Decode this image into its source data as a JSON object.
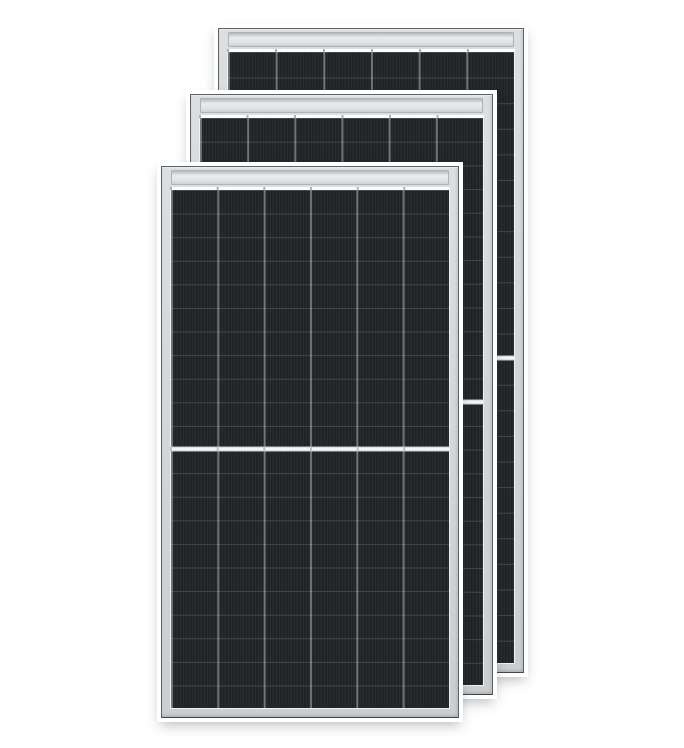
{
  "scene": {
    "description": "Product image: three stacked rectangular solar panels with black half-cut cells and silver aluminum frames on a plain white background",
    "background_color": "#ffffff"
  },
  "panel_spec": {
    "panel_count": 3,
    "cell_columns": 6,
    "cell_rows_per_half": 12,
    "halves_per_panel": 2,
    "center_divider_color": "#f3f4f5",
    "frame_color": "#d3d6d8",
    "frame_edge_color": "#5c6163",
    "cell_color": "#202326",
    "column_line_color": "rgba(255,255,255,0.35)",
    "halo_color": "#ffffff"
  },
  "panels": [
    {
      "id": "back",
      "x": 218,
      "y": 28,
      "width": 306,
      "height": 645,
      "row_height_px": 25.6,
      "z": 1
    },
    {
      "id": "middle",
      "x": 190,
      "y": 94,
      "width": 303,
      "height": 601,
      "row_height_px": 23.7,
      "z": 2
    },
    {
      "id": "front",
      "x": 161,
      "y": 166,
      "width": 298,
      "height": 552,
      "row_height_px": 23.6,
      "z": 3
    }
  ]
}
